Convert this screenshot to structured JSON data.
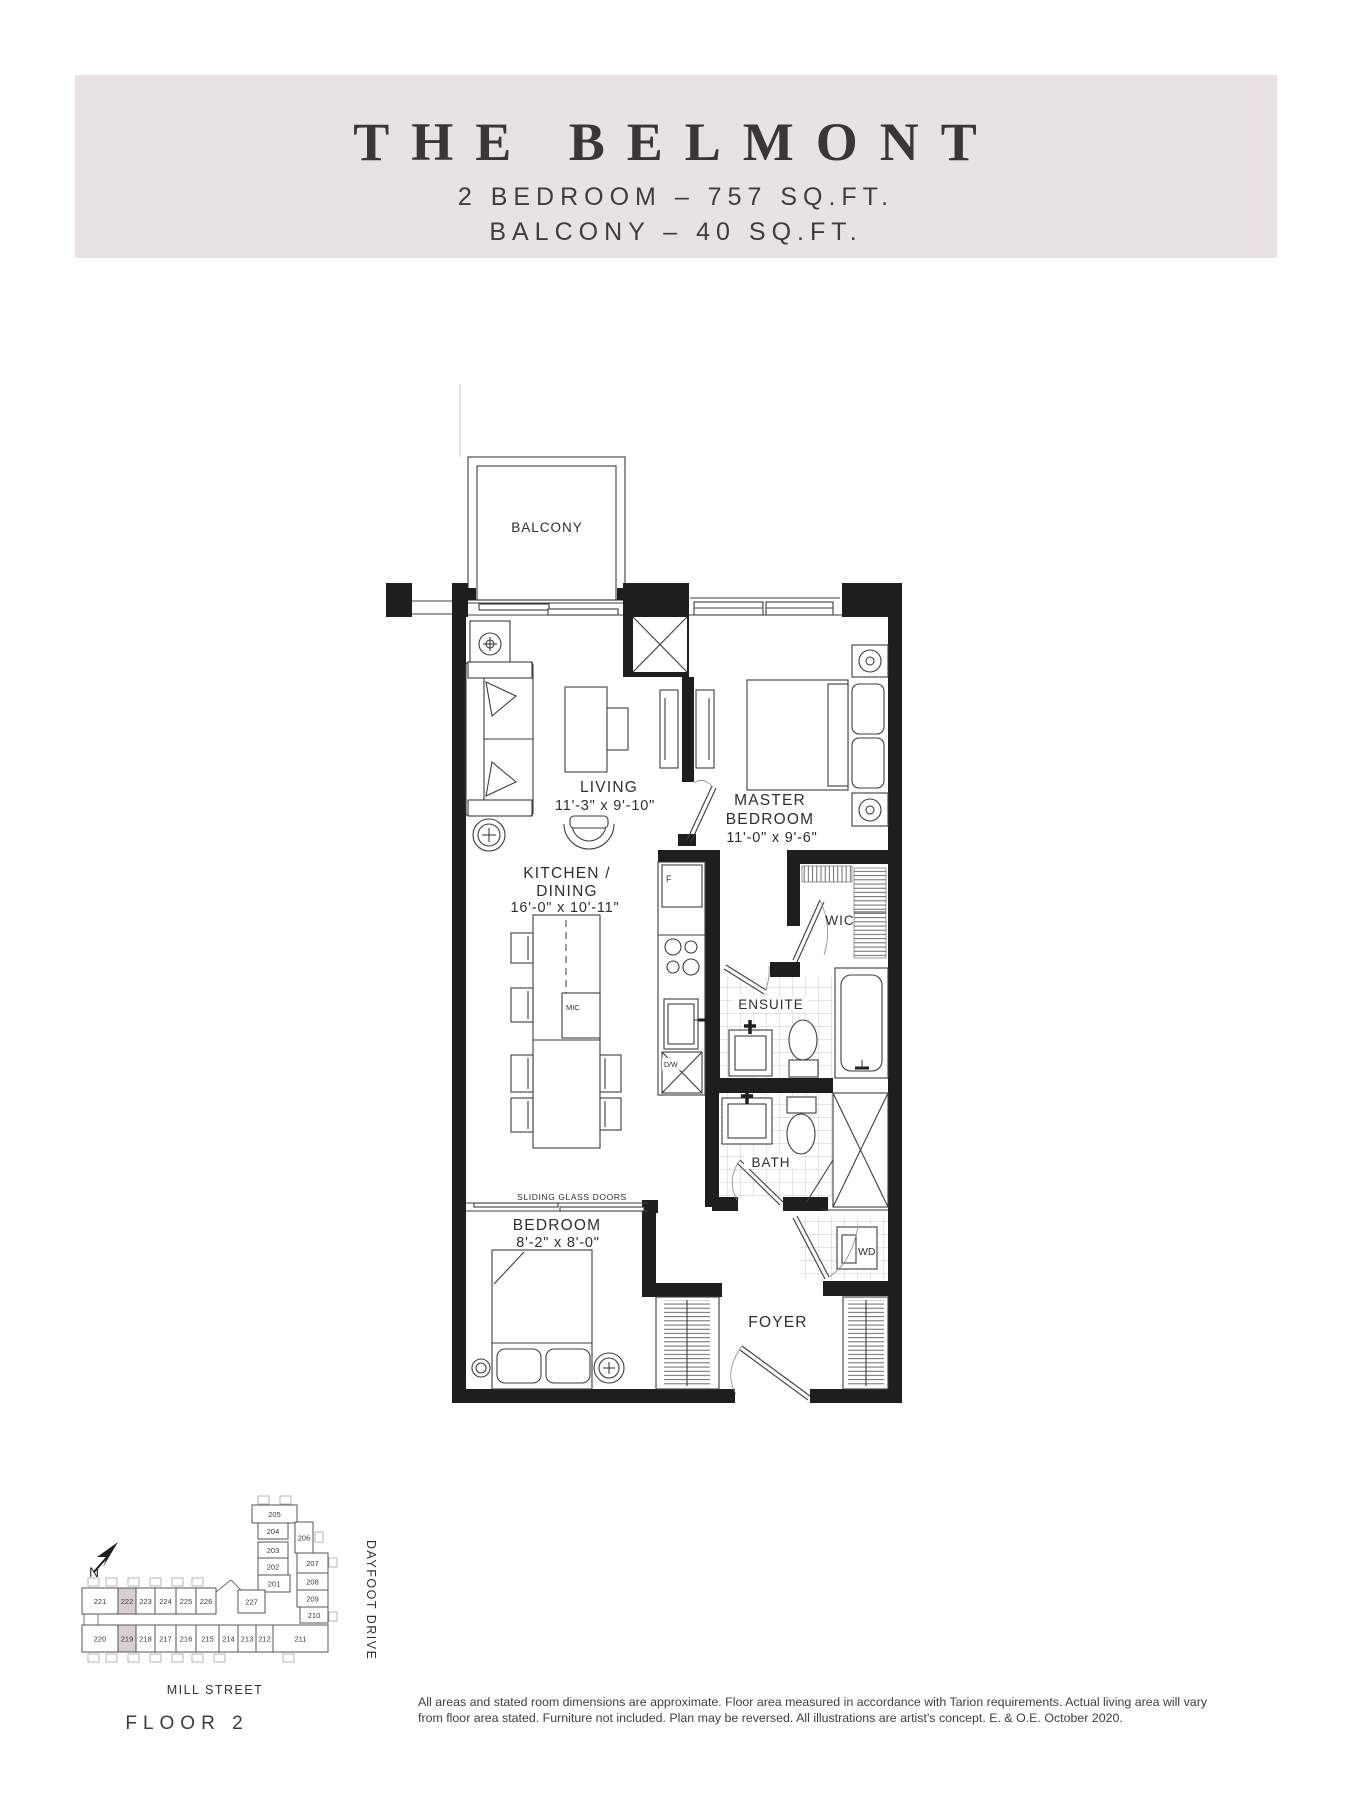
{
  "header": {
    "title": "THE BELMONT",
    "subtitle1": "2 BEDROOM – 757 SQ.FT.",
    "subtitle2": "BALCONY – 40 SQ.FT."
  },
  "colors": {
    "header_bg": "#e9e2e5",
    "wall": "#1e1e1e",
    "line": "#3d3d3d",
    "keyplan_highlight": "#d6d0d3"
  },
  "plan": {
    "balcony": "BALCONY",
    "living": {
      "name": "LIVING",
      "dims": "11'-3\" x 9'-10\""
    },
    "master": {
      "name1": "MASTER",
      "name2": "BEDROOM",
      "dims": "11'-0\" x 9'-6\""
    },
    "kitchen": {
      "name1": "KITCHEN /",
      "name2": "DINING",
      "dims": "16'-0\" x 10'-11\""
    },
    "wic": "WIC",
    "ensuite": "ENSUITE",
    "bath": "BATH",
    "bedroom": {
      "name": "BEDROOM",
      "dims": "8'-2\" x 8'-0\""
    },
    "foyer": "FOYER",
    "wd": "WD",
    "sliding_doors": "SLIDING GLASS DOORS",
    "fridge": "F",
    "dishwasher": "D/W",
    "microwave": "MIC"
  },
  "keyplan": {
    "compass": "N",
    "street_right": "DAYFOOT DRIVE",
    "street_bottom": "MILL STREET",
    "floor_label": "FLOOR 2",
    "highlighted": [
      "222",
      "219"
    ],
    "rows": [
      {
        "y": 1588,
        "h": 26,
        "cells": [
          [
            82,
            36,
            "221"
          ],
          [
            118,
            18,
            "222"
          ],
          [
            136,
            19,
            "223"
          ],
          [
            155,
            21,
            "224"
          ],
          [
            176,
            20,
            "225"
          ],
          [
            196,
            20,
            "226"
          ]
        ]
      },
      {
        "y": 1625,
        "h": 27,
        "cells": [
          [
            82,
            36,
            "220"
          ],
          [
            118,
            18,
            "219"
          ],
          [
            136,
            19,
            "218"
          ],
          [
            155,
            21,
            "217"
          ],
          [
            176,
            20,
            "216"
          ],
          [
            196,
            23,
            "215"
          ],
          [
            219,
            19,
            "214"
          ],
          [
            238,
            18,
            "213"
          ],
          [
            256,
            17,
            "212"
          ],
          [
            273,
            55,
            "211"
          ]
        ]
      }
    ],
    "wing": [
      [
        252,
        1505,
        45,
        18,
        "205"
      ],
      [
        258,
        1523,
        30,
        16,
        "204"
      ],
      [
        258,
        1542,
        30,
        16,
        "203"
      ],
      [
        258,
        1558,
        30,
        17,
        "202"
      ],
      [
        258,
        1575,
        32,
        17,
        "201"
      ],
      [
        295,
        1522,
        18,
        31,
        "206"
      ],
      [
        297,
        1553,
        31,
        20,
        "207"
      ],
      [
        297,
        1573,
        31,
        17,
        "208"
      ],
      [
        297,
        1590,
        31,
        17,
        "209"
      ],
      [
        300,
        1607,
        28,
        16,
        "210"
      ],
      [
        238,
        1590,
        27,
        23,
        "227"
      ]
    ]
  },
  "disclaimer": {
    "line1": "All areas and stated room dimensions are approximate. Floor area measured in accordance with Tarion requirements. Actual living area will vary",
    "line2": "from floor area stated. Furniture not included. Plan may be reversed. All illustrations are artist's concept. E. & O.E. October 2020."
  }
}
